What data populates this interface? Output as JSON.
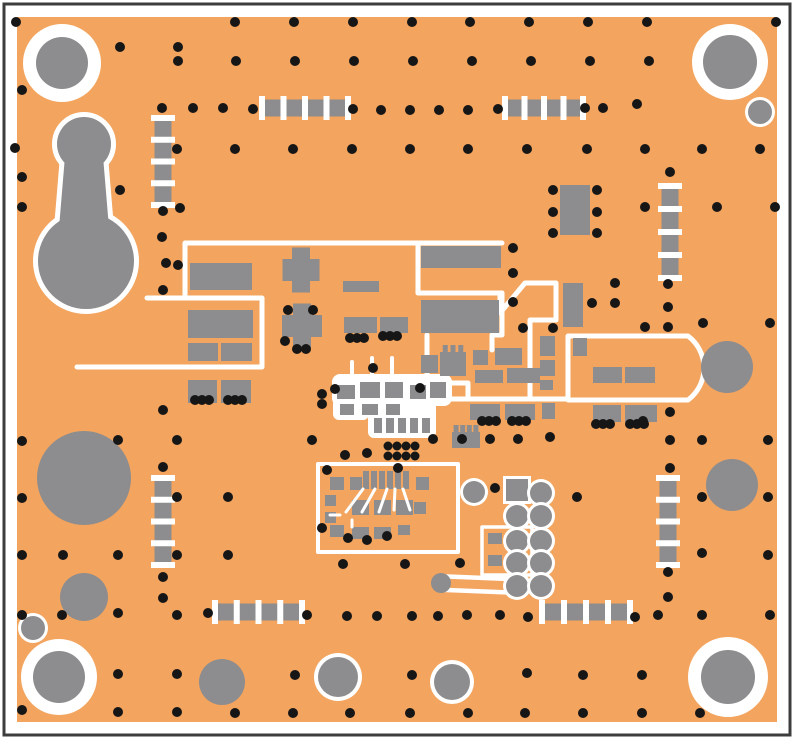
{
  "colors": {
    "page_bg": "#ffffff",
    "frame": "#3d3d3d",
    "board": "#f3a45e",
    "pad_gray": "#8d8d8f",
    "silk_white": "#ffffff",
    "via_black": "#161616"
  },
  "frame": {
    "x": 4,
    "y": 4,
    "w": 786,
    "h": 731,
    "stroke_w": 3
  },
  "board": {
    "x": 17,
    "y": 17,
    "w": 760,
    "h": 705
  },
  "mount_holes": [
    {
      "cx": 62,
      "cy": 63,
      "ring_r": 39,
      "pad_r": 26
    },
    {
      "cx": 730,
      "cy": 62,
      "ring_r": 38,
      "pad_r": 27
    },
    {
      "cx": 59,
      "cy": 677,
      "ring_r": 38,
      "pad_r": 26
    },
    {
      "cx": 728,
      "cy": 677,
      "ring_r": 40,
      "pad_r": 27
    }
  ],
  "small_ring_pads": [
    {
      "cx": 760,
      "cy": 112,
      "r": 12,
      "ring": 3
    },
    {
      "cx": 33,
      "cy": 628,
      "r": 12,
      "ring": 3
    },
    {
      "cx": 338,
      "cy": 677,
      "r": 20,
      "ring": 4
    },
    {
      "cx": 452,
      "cy": 682,
      "r": 18,
      "ring": 4
    }
  ],
  "plain_circles": [
    {
      "cx": 222,
      "cy": 682,
      "r": 23
    },
    {
      "cx": 84,
      "cy": 478,
      "r": 47
    },
    {
      "cx": 84,
      "cy": 597,
      "r": 24
    },
    {
      "cx": 732,
      "cy": 485,
      "r": 26
    }
  ],
  "rf_circle": {
    "cx": 727,
    "cy": 367,
    "r": 26
  },
  "teardrop": {
    "top_circle": {
      "cx": 84,
      "cy": 144,
      "r": 27
    },
    "stem": "66,144 102,144 110,240 58,240",
    "big_circle": {
      "cx": 86,
      "cy": 261,
      "r": 48
    },
    "outline_w": 10
  },
  "silk_paths": [
    {
      "d": "M 185,297 L 185,243 L 502,243",
      "w": 5
    },
    {
      "d": "M 418,243 L 418,293",
      "w": 5
    },
    {
      "d": "M 418,293 L 502,293",
      "w": 5
    },
    {
      "d": "M 147,298 L 262,298 L 262,366",
      "w": 5
    },
    {
      "d": "M 77,367 L 262,367",
      "w": 5
    },
    {
      "d": "M 502,293 L 502,335 L 492,335 L 492,350",
      "w": 5
    },
    {
      "d": "M 500,296 L 500,313 L 525,283 L 556,283 L 556,320 L 530,320 L 530,399",
      "w": 5
    },
    {
      "d": "M 568,337 L 568,399",
      "w": 5
    },
    {
      "d": "M 568,336 L 688,336 A 40,40 0 0 1 688,400 L 568,400",
      "w": 5
    },
    {
      "d": "M 430,399 L 568,399",
      "w": 5
    },
    {
      "d": "M 427,335 L 427,378 L 440,383 L 468,383 L 468,399",
      "w": 5
    },
    {
      "d": "M 352,362 L 352,376",
      "w": 4
    },
    {
      "d": "M 372,358 L 372,376",
      "w": 4
    },
    {
      "d": "M 392,358 L 392,376",
      "w": 4
    }
  ],
  "silk_boxes": [
    {
      "x": 318,
      "y": 464,
      "w": 140,
      "h": 88,
      "sw": 4
    },
    {
      "x": 482,
      "y": 527,
      "w": 50,
      "h": 48,
      "sw": 3.5
    }
  ],
  "white_blobs": [
    {
      "x": 332,
      "y": 374,
      "w": 120,
      "h": 32,
      "rx": 8
    },
    {
      "x": 368,
      "y": 398,
      "w": 68,
      "h": 40,
      "rx": 6
    },
    {
      "x": 333,
      "y": 398,
      "w": 36,
      "h": 22,
      "rx": 6
    }
  ],
  "box_traces": [
    "M 363,489 L 346,512",
    "M 375,489 L 362,512",
    "M 387,489 L 379,512",
    "M 395,489 L 394,510",
    "M 403,489 L 410,510",
    "M 340,515 L 330,515",
    "M 352,520 L 352,527"
  ],
  "dumbbell": {
    "x1": 441,
    "y1": 583,
    "x2": 515,
    "y2": 586,
    "outer_w": 18,
    "inner_w": 9,
    "end_r": 10
  },
  "passive_footprints": [
    {
      "o": "h",
      "x": 262,
      "y": 108,
      "len": 86
    },
    {
      "o": "h",
      "x": 505,
      "y": 108,
      "len": 78
    },
    {
      "o": "h",
      "x": 215,
      "y": 612,
      "len": 87
    },
    {
      "o": "h",
      "x": 542,
      "y": 612,
      "len": 88
    },
    {
      "o": "v",
      "x": 163,
      "y": 118,
      "len": 87
    },
    {
      "o": "v",
      "x": 163,
      "y": 478,
      "len": 87
    },
    {
      "o": "v",
      "x": 670,
      "y": 186,
      "len": 92
    },
    {
      "o": "v",
      "x": 668,
      "y": 478,
      "len": 87
    }
  ],
  "footprint_style": {
    "bar_w": 17,
    "tick_w": 6,
    "tick_overhang": 12,
    "ticks": 5
  },
  "sot_component": {
    "x": 560,
    "y": 185,
    "w": 30,
    "h": 50
  },
  "cross_pads": [
    {
      "cx": 301,
      "cy": 270,
      "vw": 18,
      "vh": 45,
      "hw": 37,
      "hh": 22
    },
    {
      "cx": 302,
      "cy": 326,
      "vw": 18,
      "vh": 45,
      "hw": 40,
      "hh": 22
    }
  ],
  "comb_pads": [
    {
      "x": 440,
      "y": 352,
      "w": 26,
      "h": 24,
      "teeth": 3
    },
    {
      "x": 452,
      "y": 432,
      "w": 28,
      "h": 16,
      "teeth": 4
    }
  ],
  "pads": [
    [
      190,
      263,
      62,
      27
    ],
    [
      343,
      281,
      36,
      11
    ],
    [
      421,
      246,
      80,
      22
    ],
    [
      421,
      300,
      78,
      33
    ],
    [
      188,
      310,
      65,
      28
    ],
    [
      188,
      343,
      30,
      18
    ],
    [
      221,
      343,
      31,
      18
    ],
    [
      344,
      317,
      33,
      16
    ],
    [
      380,
      317,
      28,
      16
    ],
    [
      188,
      380,
      29,
      23
    ],
    [
      221,
      380,
      30,
      23
    ],
    [
      421,
      355,
      17,
      18
    ],
    [
      563,
      283,
      20,
      44
    ],
    [
      540,
      336,
      15,
      20
    ],
    [
      540,
      360,
      15,
      16
    ],
    [
      540,
      380,
      13,
      10
    ],
    [
      542,
      403,
      13,
      16
    ],
    [
      573,
      338,
      14,
      18
    ],
    [
      473,
      350,
      15,
      15
    ],
    [
      495,
      348,
      27,
      17
    ],
    [
      475,
      370,
      28,
      13
    ],
    [
      507,
      368,
      33,
      15
    ],
    [
      593,
      367,
      29,
      16
    ],
    [
      625,
      367,
      30,
      16
    ],
    [
      470,
      404,
      30,
      16
    ],
    [
      505,
      404,
      30,
      16
    ],
    [
      593,
      405,
      28,
      17
    ],
    [
      625,
      405,
      32,
      17
    ],
    [
      488,
      533,
      14,
      11
    ],
    [
      488,
      555,
      14,
      11
    ],
    [
      337,
      385,
      18,
      14
    ],
    [
      360,
      382,
      20,
      16
    ],
    [
      385,
      382,
      18,
      16
    ],
    [
      410,
      385,
      16,
      14
    ],
    [
      430,
      382,
      16,
      16
    ],
    [
      340,
      404,
      14,
      11
    ],
    [
      362,
      404,
      16,
      11
    ],
    [
      386,
      404,
      14,
      11
    ],
    [
      374,
      418,
      8,
      15
    ],
    [
      386,
      418,
      8,
      15
    ],
    [
      398,
      418,
      8,
      15
    ],
    [
      410,
      418,
      8,
      15
    ],
    [
      422,
      418,
      8,
      15
    ],
    [
      330,
      477,
      14,
      13
    ],
    [
      350,
      477,
      12,
      13
    ],
    [
      363,
      471,
      6,
      18
    ],
    [
      371,
      471,
      6,
      18
    ],
    [
      379,
      471,
      6,
      18
    ],
    [
      387,
      471,
      6,
      18
    ],
    [
      395,
      471,
      6,
      18
    ],
    [
      403,
      471,
      6,
      18
    ],
    [
      416,
      477,
      13,
      13
    ],
    [
      352,
      500,
      17,
      15
    ],
    [
      374,
      500,
      17,
      15
    ],
    [
      396,
      500,
      17,
      15
    ],
    [
      414,
      502,
      12,
      12
    ],
    [
      330,
      525,
      14,
      12
    ],
    [
      352,
      527,
      17,
      12
    ],
    [
      374,
      527,
      17,
      12
    ],
    [
      398,
      525,
      12,
      10
    ],
    [
      325,
      495,
      11,
      11
    ],
    [
      325,
      512,
      11,
      11
    ]
  ],
  "header": {
    "square": {
      "x": 506,
      "y": 479,
      "w": 22,
      "h": 22,
      "sw": 3
    },
    "pin_r": 11,
    "ring_w": 3,
    "pins": [
      {
        "cx": 474,
        "cy": 492
      },
      {
        "cx": 517,
        "cy": 516
      },
      {
        "cx": 517,
        "cy": 541
      },
      {
        "cx": 517,
        "cy": 563
      },
      {
        "cx": 517,
        "cy": 586
      },
      {
        "cx": 541,
        "cy": 493
      },
      {
        "cx": 541,
        "cy": 516
      },
      {
        "cx": 541,
        "cy": 541
      },
      {
        "cx": 541,
        "cy": 563
      },
      {
        "cx": 541,
        "cy": 586
      }
    ]
  },
  "vias": [
    [
      16,
      22
    ],
    [
      235,
      22
    ],
    [
      294,
      22
    ],
    [
      353,
      22
    ],
    [
      412,
      22
    ],
    [
      470,
      22
    ],
    [
      529,
      22
    ],
    [
      588,
      22
    ],
    [
      647,
      22
    ],
    [
      776,
      22
    ],
    [
      120,
      47
    ],
    [
      178,
      47
    ],
    [
      178,
      61
    ],
    [
      236,
      61
    ],
    [
      295,
      61
    ],
    [
      354,
      61
    ],
    [
      413,
      61
    ],
    [
      472,
      61
    ],
    [
      531,
      61
    ],
    [
      590,
      61
    ],
    [
      649,
      61
    ],
    [
      22,
      90
    ],
    [
      162,
      108
    ],
    [
      193,
      108
    ],
    [
      223,
      108
    ],
    [
      253,
      109
    ],
    [
      353,
      109
    ],
    [
      381,
      110
    ],
    [
      410,
      110
    ],
    [
      439,
      110
    ],
    [
      468,
      110
    ],
    [
      498,
      109
    ],
    [
      585,
      108
    ],
    [
      603,
      108
    ],
    [
      637,
      104
    ],
    [
      15,
      148
    ],
    [
      177,
      149
    ],
    [
      235,
      149
    ],
    [
      293,
      149
    ],
    [
      352,
      149
    ],
    [
      410,
      149
    ],
    [
      468,
      149
    ],
    [
      527,
      149
    ],
    [
      587,
      149
    ],
    [
      645,
      149
    ],
    [
      702,
      149
    ],
    [
      760,
      149
    ],
    [
      22,
      177
    ],
    [
      120,
      190
    ],
    [
      22,
      207
    ],
    [
      163,
      211
    ],
    [
      180,
      208
    ],
    [
      645,
      207
    ],
    [
      717,
      207
    ],
    [
      775,
      207
    ],
    [
      670,
      172
    ],
    [
      553,
      190
    ],
    [
      553,
      212
    ],
    [
      553,
      233
    ],
    [
      597,
      190
    ],
    [
      597,
      212
    ],
    [
      597,
      233
    ],
    [
      162,
      237
    ],
    [
      166,
      263
    ],
    [
      178,
      265
    ],
    [
      163,
      290
    ],
    [
      513,
      248
    ],
    [
      513,
      273
    ],
    [
      513,
      302
    ],
    [
      592,
      303
    ],
    [
      615,
      283
    ],
    [
      615,
      303
    ],
    [
      288,
      310
    ],
    [
      313,
      310
    ],
    [
      285,
      341
    ],
    [
      297,
      349
    ],
    [
      306,
      349
    ],
    [
      350,
      338
    ],
    [
      357,
      338
    ],
    [
      364,
      338
    ],
    [
      383,
      336
    ],
    [
      390,
      336
    ],
    [
      397,
      336
    ],
    [
      668,
      284
    ],
    [
      668,
      307
    ],
    [
      703,
      323
    ],
    [
      770,
      323
    ],
    [
      523,
      328
    ],
    [
      553,
      328
    ],
    [
      645,
      327
    ],
    [
      668,
      327
    ],
    [
      195,
      400
    ],
    [
      202,
      400
    ],
    [
      209,
      400
    ],
    [
      228,
      400
    ],
    [
      235,
      400
    ],
    [
      242,
      400
    ],
    [
      373,
      368
    ],
    [
      335,
      389
    ],
    [
      322,
      394
    ],
    [
      322,
      404
    ],
    [
      420,
      388
    ],
    [
      312,
      440
    ],
    [
      345,
      455
    ],
    [
      367,
      453
    ],
    [
      482,
      421
    ],
    [
      489,
      421
    ],
    [
      496,
      421
    ],
    [
      512,
      421
    ],
    [
      519,
      421
    ],
    [
      526,
      421
    ],
    [
      596,
      424
    ],
    [
      603,
      424
    ],
    [
      610,
      424
    ],
    [
      630,
      424
    ],
    [
      637,
      424
    ],
    [
      644,
      424
    ],
    [
      433,
      439
    ],
    [
      462,
      439
    ],
    [
      490,
      439
    ],
    [
      518,
      439
    ],
    [
      550,
      437
    ],
    [
      163,
      410
    ],
    [
      22,
      441
    ],
    [
      118,
      440
    ],
    [
      177,
      440
    ],
    [
      163,
      467
    ],
    [
      22,
      498
    ],
    [
      177,
      497
    ],
    [
      228,
      497
    ],
    [
      670,
      412
    ],
    [
      643,
      421
    ],
    [
      670,
      440
    ],
    [
      702,
      440
    ],
    [
      768,
      440
    ],
    [
      670,
      468
    ],
    [
      702,
      497
    ],
    [
      768,
      497
    ],
    [
      702,
      553
    ],
    [
      768,
      555
    ],
    [
      577,
      497
    ],
    [
      22,
      555
    ],
    [
      63,
      555
    ],
    [
      118,
      555
    ],
    [
      177,
      555
    ],
    [
      228,
      555
    ],
    [
      163,
      577
    ],
    [
      343,
      564
    ],
    [
      405,
      564
    ],
    [
      460,
      563
    ],
    [
      495,
      488
    ],
    [
      327,
      470
    ],
    [
      398,
      468
    ],
    [
      322,
      528
    ],
    [
      348,
      538
    ],
    [
      367,
      540
    ],
    [
      387,
      536
    ],
    [
      668,
      572
    ],
    [
      668,
      597
    ],
    [
      163,
      598
    ],
    [
      22,
      615
    ],
    [
      62,
      615
    ],
    [
      118,
      613
    ],
    [
      177,
      615
    ],
    [
      208,
      613
    ],
    [
      307,
      615
    ],
    [
      347,
      616
    ],
    [
      377,
      616
    ],
    [
      412,
      616
    ],
    [
      438,
      616
    ],
    [
      467,
      615
    ],
    [
      500,
      615
    ],
    [
      528,
      617
    ],
    [
      635,
      617
    ],
    [
      658,
      615
    ],
    [
      702,
      615
    ],
    [
      770,
      615
    ],
    [
      118,
      674
    ],
    [
      177,
      674
    ],
    [
      295,
      675
    ],
    [
      412,
      675
    ],
    [
      527,
      673
    ],
    [
      583,
      675
    ],
    [
      642,
      675
    ],
    [
      22,
      710
    ],
    [
      118,
      712
    ],
    [
      177,
      712
    ],
    [
      235,
      713
    ],
    [
      293,
      713
    ],
    [
      350,
      713
    ],
    [
      410,
      713
    ],
    [
      468,
      713
    ],
    [
      525,
      713
    ],
    [
      583,
      713
    ],
    [
      642,
      713
    ],
    [
      700,
      713
    ]
  ],
  "via_r": 5,
  "thermal_vias": {
    "r": 4.5,
    "points": [
      [
        388,
        446
      ],
      [
        397,
        446
      ],
      [
        406,
        446
      ],
      [
        415,
        446
      ],
      [
        388,
        456
      ],
      [
        397,
        456
      ],
      [
        406,
        456
      ],
      [
        415,
        456
      ]
    ]
  }
}
